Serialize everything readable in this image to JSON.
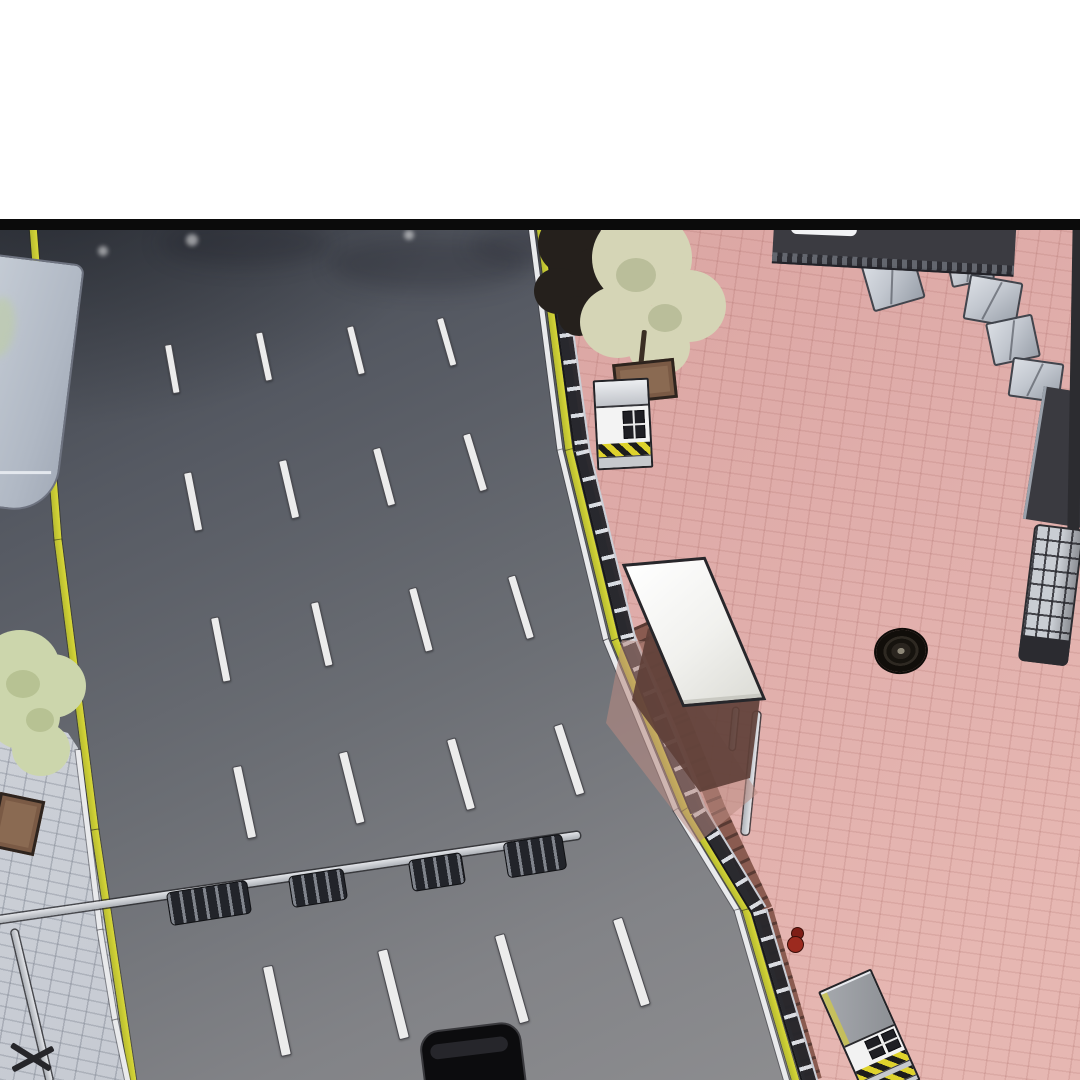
{
  "panel": {
    "kind": "webtoon-panel-aerial-street-scene",
    "top_margin_color": "#ffffff",
    "border_color": "#0b0b0b"
  },
  "palette": {
    "road_dark": "#3f434b",
    "road_light": "#929294",
    "plaza_pink": "#dca7a4",
    "plaza_pink_light": "#e6b7b2",
    "lane_marking": "#ececec",
    "edge_line_yellow": "#d8d838",
    "sidewalk": "#ccd0d6",
    "dirt_strip": "#8a5b50",
    "shelter_roof": "#f5f5f3",
    "shadow_brown": "#5f4038",
    "tree_green": "#ccd6ac",
    "tree_khaki": "#d5d5b6",
    "tree_dark": "#25201c",
    "hazard_yellow": "#ded22c",
    "crate_gray": "#c2c7cf",
    "car_black": "#0c0c0e",
    "red_object": "#9c2a1f"
  },
  "objects": [
    "road",
    "pedestrian-plaza",
    "sidewalk",
    "guard-fence",
    "bus-shelter",
    "guard-booth",
    "utility-booth",
    "manhole-cover",
    "tiled-pillar",
    "rooftop-structure",
    "crates",
    "bike-racks",
    "bike-rail",
    "street-lamp",
    "bus-roof",
    "trees",
    "planters",
    "black-car",
    "red-figure"
  ],
  "scene": {
    "lane_dashes": [
      {
        "x": 164,
        "y": 115,
        "len": 48,
        "w": 6,
        "angle": -10
      },
      {
        "x": 255,
        "y": 103,
        "len": 48,
        "w": 6,
        "angle": -12
      },
      {
        "x": 346,
        "y": 97,
        "len": 48,
        "w": 6,
        "angle": -14
      },
      {
        "x": 436,
        "y": 89,
        "len": 48,
        "w": 6,
        "angle": -16
      },
      {
        "x": 183,
        "y": 243,
        "len": 58,
        "w": 7,
        "angle": -11
      },
      {
        "x": 278,
        "y": 231,
        "len": 58,
        "w": 7,
        "angle": -13
      },
      {
        "x": 372,
        "y": 219,
        "len": 58,
        "w": 7,
        "angle": -15
      },
      {
        "x": 462,
        "y": 205,
        "len": 58,
        "w": 7,
        "angle": -17
      },
      {
        "x": 210,
        "y": 388,
        "len": 64,
        "w": 7,
        "angle": -11
      },
      {
        "x": 310,
        "y": 373,
        "len": 64,
        "w": 7,
        "angle": -13
      },
      {
        "x": 408,
        "y": 359,
        "len": 64,
        "w": 7,
        "angle": -15
      },
      {
        "x": 507,
        "y": 347,
        "len": 64,
        "w": 7,
        "angle": -17
      },
      {
        "x": 232,
        "y": 537,
        "len": 72,
        "w": 8,
        "angle": -12
      },
      {
        "x": 338,
        "y": 523,
        "len": 72,
        "w": 8,
        "angle": -14
      },
      {
        "x": 446,
        "y": 510,
        "len": 72,
        "w": 8,
        "angle": -16
      },
      {
        "x": 553,
        "y": 496,
        "len": 72,
        "w": 8,
        "angle": -18
      },
      {
        "x": 262,
        "y": 737,
        "len": 90,
        "w": 9,
        "angle": -12
      },
      {
        "x": 377,
        "y": 721,
        "len": 90,
        "w": 9,
        "angle": -14
      },
      {
        "x": 494,
        "y": 706,
        "len": 90,
        "w": 9,
        "angle": -16
      },
      {
        "x": 612,
        "y": 690,
        "len": 90,
        "w": 9,
        "angle": -18
      }
    ],
    "lines": [
      {
        "name": "dirt-strip",
        "cls": "dirt-strip",
        "width": 16,
        "points": [
          [
            640,
            395
          ],
          [
            682,
            490
          ],
          [
            718,
            580
          ],
          [
            765,
            680
          ],
          [
            814,
            850
          ]
        ]
      },
      {
        "name": "left-road-edge-yellow",
        "cls": "yellow-line",
        "width": 7,
        "points": [
          [
            33,
            -4
          ],
          [
            58,
            310
          ],
          [
            95,
            600
          ],
          [
            133,
            852
          ]
        ]
      },
      {
        "name": "right-road-edge-white",
        "cls": "white-line",
        "width": 5,
        "points": [
          [
            531,
            -4
          ],
          [
            560,
            220
          ],
          [
            606,
            410
          ],
          [
            676,
            580
          ],
          [
            737,
            680
          ],
          [
            787,
            852
          ]
        ]
      },
      {
        "name": "right-road-edge-yellow",
        "cls": "yellow-line",
        "width": 7,
        "points": [
          [
            540,
            -4
          ],
          [
            569,
            220
          ],
          [
            615,
            410
          ],
          [
            685,
            580
          ],
          [
            746,
            680
          ],
          [
            796,
            852
          ]
        ]
      },
      {
        "name": "sidewalk-curb-white",
        "cls": "white-line",
        "width": 5,
        "points": [
          [
            78,
            520
          ],
          [
            100,
            700
          ],
          [
            115,
            790
          ],
          [
            128,
            852
          ]
        ]
      },
      {
        "name": "guard-fence",
        "cls": "fence",
        "width": 13,
        "points": [
          [
            553,
            -4
          ],
          [
            584,
            220
          ],
          [
            630,
            410
          ],
          [
            700,
            580
          ],
          [
            761,
            680
          ],
          [
            812,
            852
          ]
        ]
      },
      {
        "name": "bike-rail",
        "cls": "pole-line",
        "width": 7,
        "points": [
          [
            -4,
            690
          ],
          [
            580,
            605
          ]
        ]
      },
      {
        "name": "street-lamp-pole",
        "cls": "pole-line",
        "width": 6,
        "points": [
          [
            14,
            700
          ],
          [
            50,
            852
          ]
        ]
      },
      {
        "name": "shelter-support-pole",
        "cls": "pole-line",
        "width": 7,
        "points": [
          [
            757,
            482
          ],
          [
            745,
            604
          ]
        ]
      },
      {
        "name": "shelter-support-post",
        "cls": "pole-line",
        "width": 5,
        "points": [
          [
            736,
            478
          ],
          [
            732,
            520
          ]
        ]
      }
    ],
    "crates": [
      {
        "x": 866,
        "y": 26,
        "w": 50,
        "h": 46,
        "rot": -16
      },
      {
        "x": 948,
        "y": 18,
        "w": 40,
        "h": 32,
        "rot": -12
      },
      {
        "x": 966,
        "y": 48,
        "w": 50,
        "h": 42,
        "rot": 10
      },
      {
        "x": 989,
        "y": 88,
        "w": 44,
        "h": 40,
        "rot": -12
      },
      {
        "x": 1010,
        "y": 130,
        "w": 48,
        "h": 36,
        "rot": 8
      }
    ],
    "bike_racks": [
      {
        "x": 168,
        "y": 656,
        "w": 80,
        "h": 32,
        "rot": -9
      },
      {
        "x": 290,
        "y": 642,
        "w": 54,
        "h": 30,
        "rot": -9
      },
      {
        "x": 410,
        "y": 626,
        "w": 52,
        "h": 30,
        "rot": -9
      },
      {
        "x": 505,
        "y": 608,
        "w": 58,
        "h": 34,
        "rot": -9
      }
    ],
    "road_smudges": [
      {
        "x": 160,
        "y": -10,
        "w": 170,
        "h": 46
      },
      {
        "x": 330,
        "y": 8,
        "w": 200,
        "h": 52
      },
      {
        "x": 470,
        "y": -4,
        "w": 120,
        "h": 38
      }
    ],
    "road_dots": [
      {
        "x": 98,
        "y": 16,
        "r": 10
      },
      {
        "x": 186,
        "y": 4,
        "r": 12
      },
      {
        "x": 404,
        "y": 0,
        "r": 10
      }
    ]
  }
}
